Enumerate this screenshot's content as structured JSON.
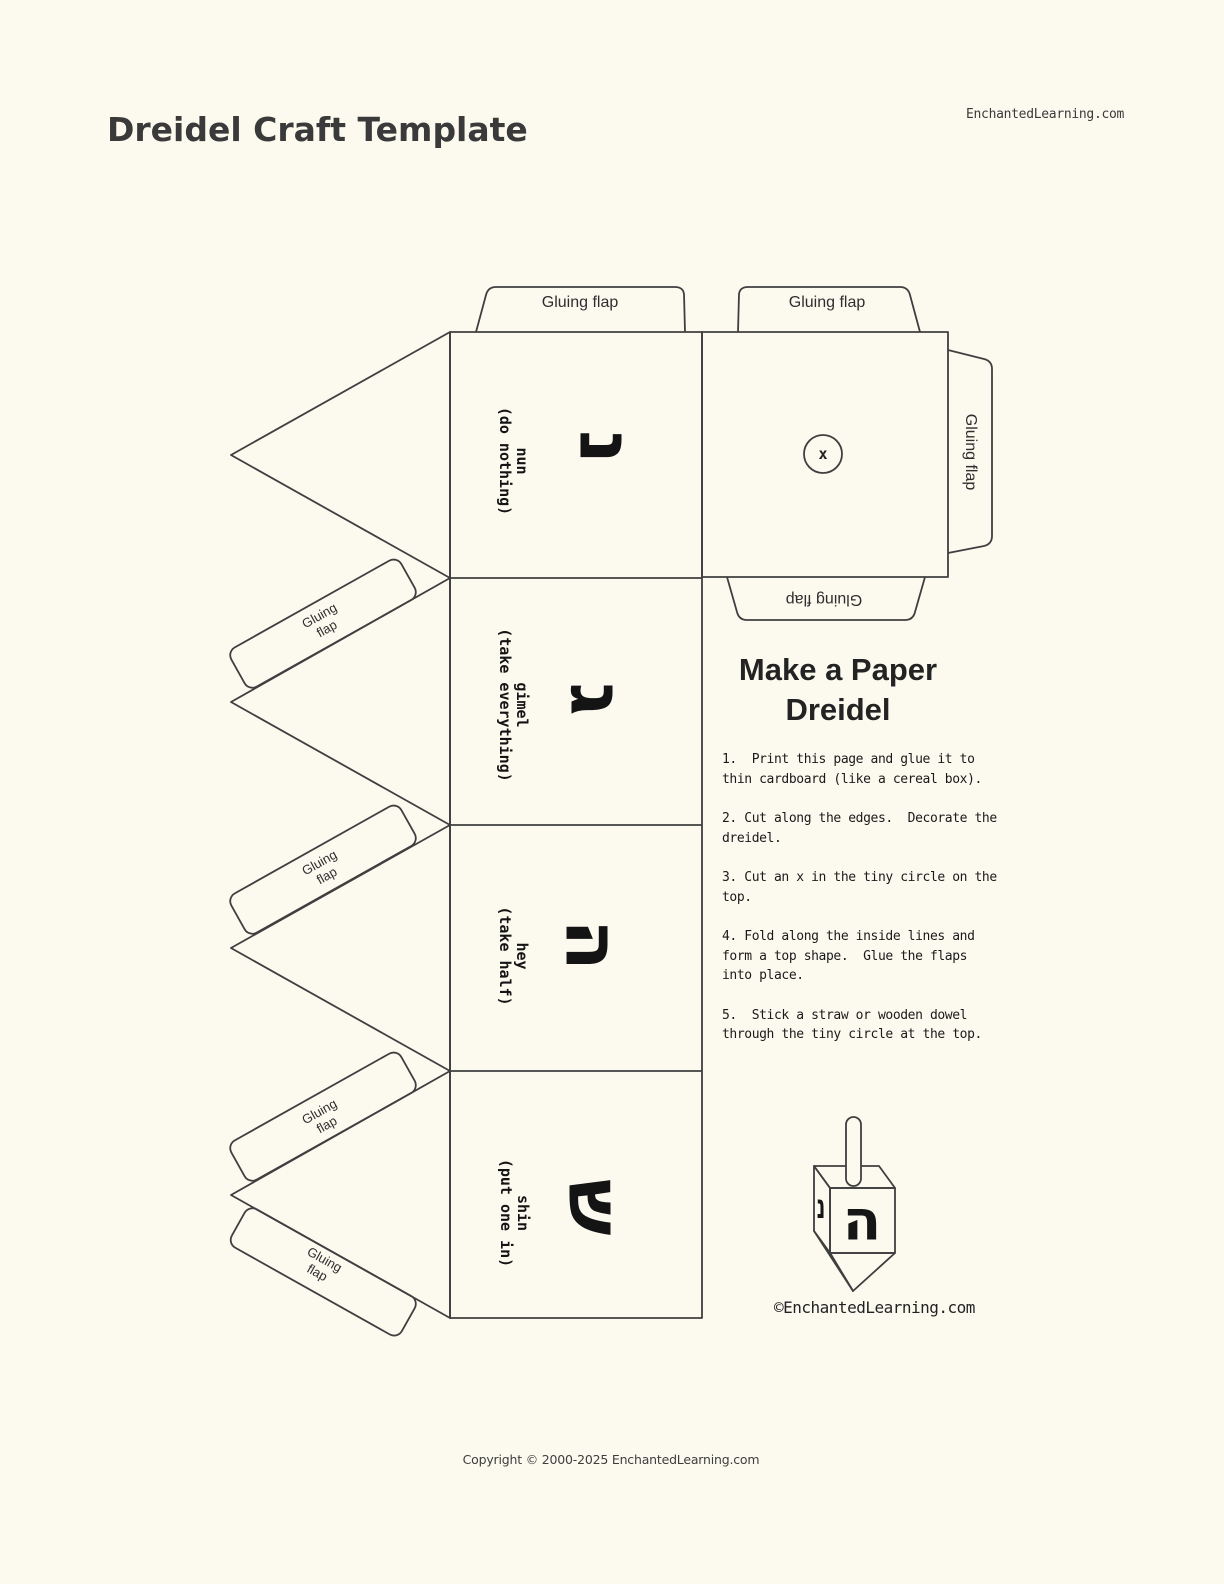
{
  "page": {
    "header_site": "EnchantedLearning.com",
    "title": "Dreidel Craft Template",
    "footer_copyright": "Copyright © 2000-2025 EnchantedLearning.com"
  },
  "template": {
    "flap_label": "Gluing flap",
    "flap_label_two_line": "Gluing\nflap",
    "circle_mark": "x",
    "faces": [
      {
        "name": "nun",
        "action": "(do nothing)",
        "letter": "נ"
      },
      {
        "name": "gimel",
        "action": "(take everything)",
        "letter": "ג"
      },
      {
        "name": "hey",
        "action": "(take half)",
        "letter": "ה"
      },
      {
        "name": "shin",
        "action": "(put one in)",
        "letter": "ש"
      }
    ]
  },
  "instructions": {
    "heading": "Make a Paper\nDreidel",
    "steps": [
      "1.  Print this page and glue it to\nthin cardboard (like a cereal box).",
      "2. Cut along the edges.  Decorate the\ndreidel.",
      "3. Cut an x in the tiny circle on the\ntop.",
      "4. Fold along the inside lines and\nform a top shape.  Glue the flaps\ninto place.",
      "5.  Stick a straw or wooden dowel\nthrough the tiny circle at the top."
    ]
  },
  "illustration": {
    "front_letter": "ה",
    "side_letter": "נ",
    "caption": "©EnchantedLearning.com"
  },
  "colors": {
    "background": "#FCFAEF",
    "line": "#3F3F3F",
    "ink": "#1C1C1C"
  }
}
